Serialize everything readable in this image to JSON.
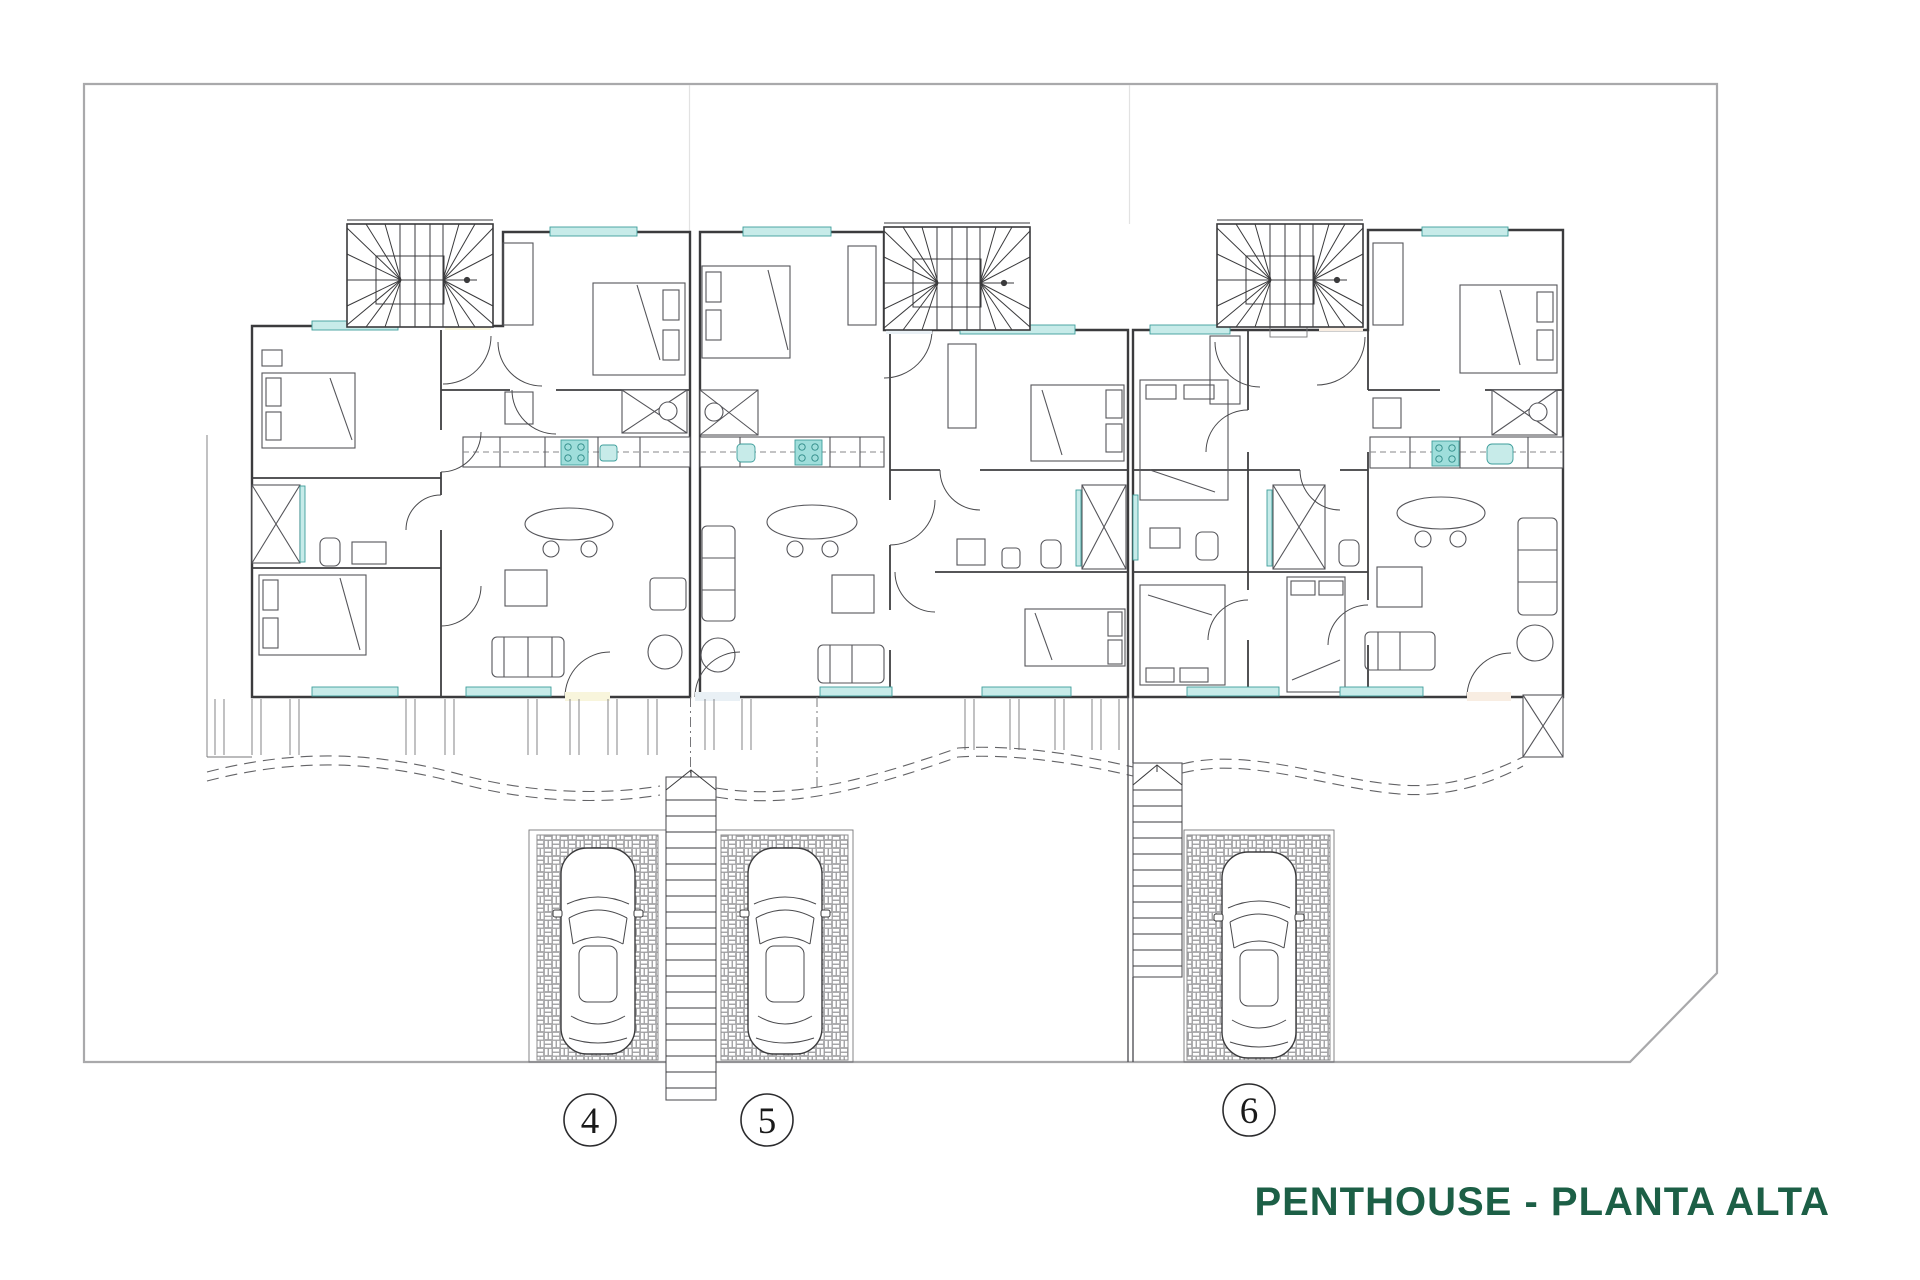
{
  "title": {
    "text": "PENTHOUSE - PLANTA ALTA",
    "color": "#1C5F46"
  },
  "plan": {
    "kind": "floor-plan",
    "level": "upper"
  },
  "units": [
    {
      "label": "4",
      "name": "Penthouse 4",
      "fill": "#F8F5DC"
    },
    {
      "label": "5",
      "name": "Penthouse 5",
      "fill": "#E9F0F5"
    },
    {
      "label": "6",
      "name": "Penthouse 6",
      "fill": "#F8EDE2"
    }
  ],
  "palette": {
    "wall": "#3B3B3D",
    "site_boundary": "#A9A9AB",
    "teal_fill": "#C7EBE9",
    "teal_stroke": "#3E9E9B",
    "hob_fill": "#9FDEDB",
    "brick_line": "#98989A",
    "paper": "#FFFFFF"
  }
}
